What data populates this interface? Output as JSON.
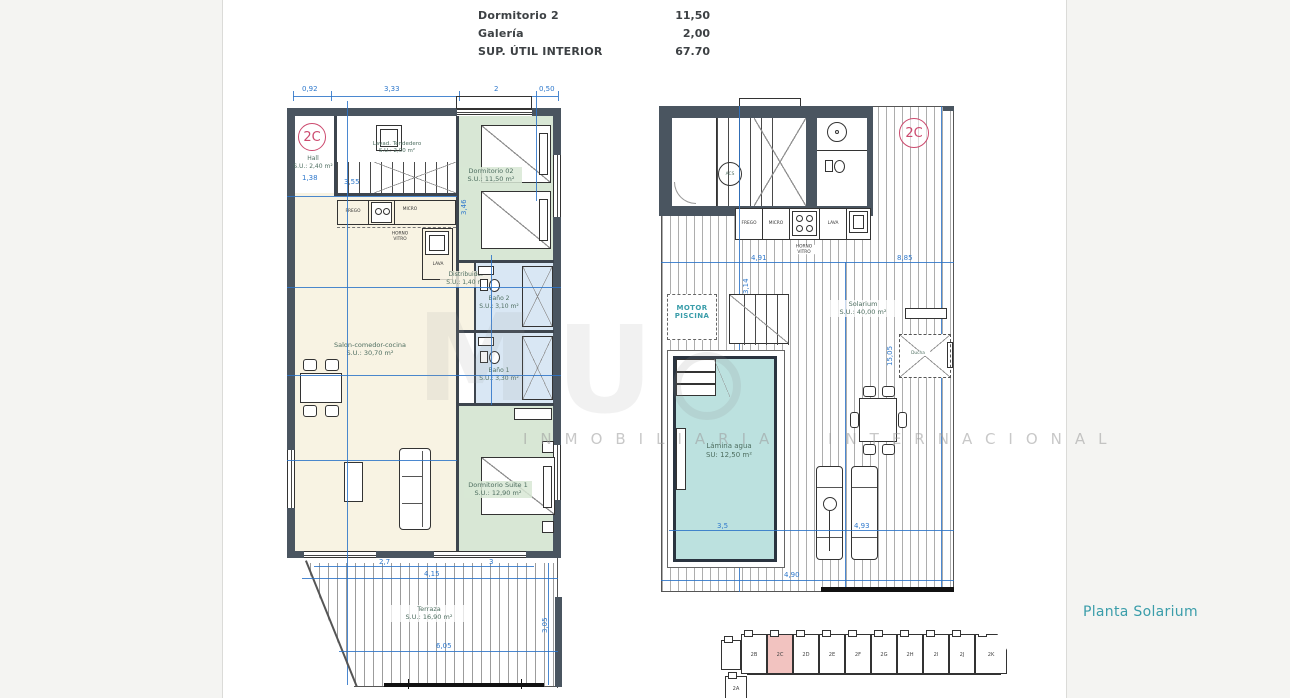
{
  "summary": {
    "rows": [
      {
        "label": "Dormitorio 2",
        "value": "11,50"
      },
      {
        "label": "Galería",
        "value": "2,00"
      },
      {
        "label": "SUP. ÚTIL INTERIOR",
        "value": "67.70"
      }
    ]
  },
  "plan_left": {
    "badge": "2C",
    "dims_top": [
      "0,92",
      "3,33",
      "2",
      "0,50"
    ],
    "rooms": {
      "hall": {
        "name": "Hall",
        "area": "S.U.: 2,40 m²"
      },
      "lavadero": {
        "name": "Lavad. Tendedero",
        "area": "S.U.: 2,00 m²"
      },
      "dormitorio2": {
        "name": "Dormitorio 02",
        "area": "S.U.: 11,50 m²"
      },
      "distribuidor": {
        "name": "Distribuidor",
        "area": "S.U.: 1,40 m²"
      },
      "bano2": {
        "name": "Baño 2",
        "area": "S.U.: 3,10 m²"
      },
      "bano1": {
        "name": "Baño 1",
        "area": "S.U.: 3,30 m²"
      },
      "salon": {
        "name": "Salon-comedor-cocina",
        "area": "S.U.: 30,70 m²"
      },
      "suite": {
        "name": "Dormitorio Suite 1",
        "area": "S.U.: 12,90 m²"
      },
      "terraza": {
        "name": "Terraza",
        "area": "S.U.: 16,90 m²"
      }
    },
    "kitchen": {
      "frego": "FREGO",
      "micro": "MICRO",
      "horno1": "HORNO",
      "horno2": "VITRO",
      "lava": "LAVA"
    },
    "dims": {
      "hall_w": "1,38",
      "stair_w": "3,55",
      "rot1": "3,46",
      "terr1": "2,7",
      "terr2": "3",
      "terr3": "4,15",
      "terr4": "6,05",
      "terr_v": "3,05"
    }
  },
  "plan_right": {
    "badge": "2C",
    "acs": "ACS",
    "motor1": "MOTOR",
    "motor2": "PISCINA",
    "solarium": {
      "name": "Solarium",
      "area": "S.U.: 40,00 m²"
    },
    "ducha": "Ducha",
    "pool": {
      "name": "Lámina agua",
      "area": "SU: 12,50 m²"
    },
    "kitchen": {
      "frego": "FREGO",
      "micro": "MICRO",
      "horno1": "HORNO",
      "horno2": "VITRO",
      "lava": "LAVA"
    },
    "dims": {
      "top1": "4,91",
      "top2": "8,85",
      "v1": "3,14",
      "v2": "15,05",
      "pool_w": "3,5",
      "mid": "4,93",
      "bottom": "4,90"
    }
  },
  "footer": {
    "title": "Planta Solarium",
    "units": [
      "2B",
      "2C",
      "2D",
      "2E",
      "2F",
      "2G",
      "2H",
      "2I",
      "2J",
      "2K"
    ],
    "active_unit": "2C",
    "unit_below": "2A"
  },
  "watermark": {
    "line": "INMOBILIARIA INTERNACIONAL",
    "glyph1": "M",
    "glyph2": "U"
  },
  "colors": {
    "dimension_blue": "#2e78cc",
    "wall_dark": "#4a5560",
    "bedroom_green": "#d8e7d5",
    "bath_blue": "#d9e7f4",
    "living_cream": "#f8f3e3",
    "pool_cyan": "#bce1df",
    "badge_red": "#cc4a6e",
    "keyplan_highlight": "#f2c3c0",
    "title_teal": "#3a9daa"
  }
}
